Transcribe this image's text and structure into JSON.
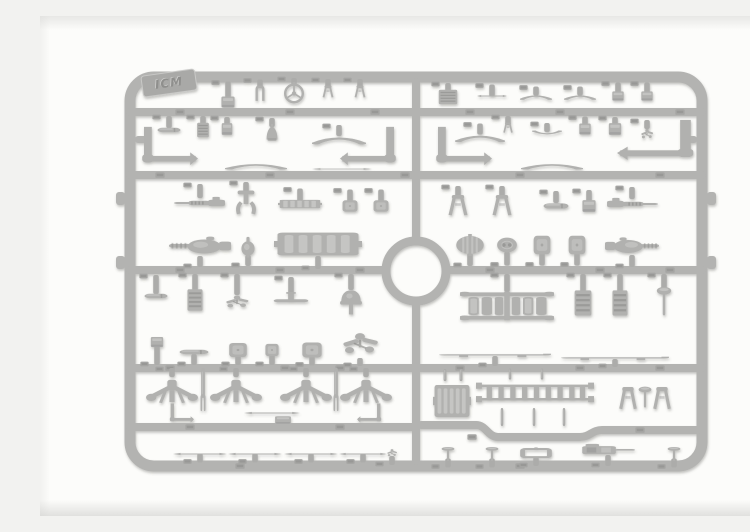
{
  "meta": {
    "alt": "Grey injection-moulded plastic model kit sprue with vehicle detail parts on a white background"
  },
  "logo": {
    "text": "ICM"
  },
  "palette": {
    "sprue": "#b3b3b1",
    "part": "#b1b1af",
    "light": "#d6d6d4",
    "dark": "#858583",
    "gate": "#acacaa",
    "tab": "#a5a5a3",
    "logoPlate": "#a9a9a7",
    "logoEdge": "#c9c9c7",
    "logoText": "#8f8f8d",
    "logoTextHi": "#cfcfcd"
  },
  "sprue": {
    "frame": {
      "x": 90,
      "y": 61,
      "w": 572,
      "h": 389,
      "r": 24,
      "bar": 11
    },
    "runners": [
      "M90 96 H662",
      "M90 159 H662",
      "M90 254 H346",
      "M406 254 H662",
      "M90 352 H662",
      "M90 411 H376",
      "M381 409 H436 C446 409 448 421 458 421 H540 C550 421 552 414 562 414 H658",
      "M376 66 V225",
      "M376 286 V445"
    ],
    "ring": {
      "cx": 376,
      "cy": 255,
      "r": 30,
      "bar": 9
    },
    "nubs": [
      [
        76,
        176,
        9,
        13
      ],
      [
        76,
        240,
        9,
        13
      ],
      [
        667,
        176,
        9,
        13
      ],
      [
        667,
        240,
        9,
        13
      ]
    ],
    "stubs": [
      [
        95,
        120,
        14,
        7
      ],
      [
        643,
        120,
        14,
        7
      ]
    ],
    "logoPos": {
      "x": 129,
      "y": 67,
      "w": 54,
      "h": 21,
      "rot": -8
    },
    "tabs": [
      [
        140,
        96
      ],
      [
        250,
        96
      ],
      [
        335,
        96
      ],
      [
        430,
        96
      ],
      [
        520,
        96
      ],
      [
        640,
        96
      ],
      [
        120,
        159
      ],
      [
        230,
        159
      ],
      [
        365,
        159
      ],
      [
        480,
        159
      ],
      [
        620,
        159
      ],
      [
        140,
        254
      ],
      [
        240,
        254
      ],
      [
        320,
        254
      ],
      [
        450,
        254
      ],
      [
        560,
        254
      ],
      [
        630,
        254
      ],
      [
        130,
        352
      ],
      [
        245,
        352
      ],
      [
        300,
        352
      ],
      [
        420,
        352
      ],
      [
        540,
        352
      ],
      [
        620,
        352
      ],
      [
        150,
        411
      ],
      [
        300,
        411
      ],
      [
        432,
        421
      ],
      [
        600,
        414
      ],
      [
        200,
        450
      ],
      [
        480,
        450
      ]
    ]
  },
  "parts": [
    {
      "n": "small-bracket",
      "t": "box",
      "x": 188,
      "y": 86,
      "w": 15,
      "h": 13,
      "gu": 14
    },
    {
      "n": "u-clamp",
      "t": "uclip",
      "x": 220,
      "y": 77,
      "w": 15,
      "h": 17,
      "gu": 5
    },
    {
      "n": "steering-wheel",
      "t": "wheel",
      "x": 254,
      "y": 77,
      "w": 22,
      "h": 22,
      "gu": 4
    },
    {
      "n": "lever-fork",
      "t": "fork",
      "x": 288,
      "y": 76,
      "w": 16,
      "h": 14,
      "gu": 6
    },
    {
      "n": "lever-fork",
      "t": "fork",
      "x": 320,
      "y": 76,
      "w": 16,
      "h": 14,
      "gu": 6
    },
    {
      "n": "vent-grille",
      "t": "grille",
      "x": 408,
      "y": 81,
      "w": 22,
      "h": 16,
      "gu": 6
    },
    {
      "n": "flat-bar",
      "t": "rodh",
      "x": 452,
      "y": 80,
      "w": 30,
      "h": 5,
      "gu": 9
    },
    {
      "n": "curved-brace",
      "t": "bow",
      "x": 496,
      "y": 81,
      "w": 32,
      "h": 9,
      "gu": 6
    },
    {
      "n": "curved-brace",
      "t": "bow",
      "x": 540,
      "y": 81,
      "w": 32,
      "h": 9,
      "gu": 6
    },
    {
      "n": "small-block",
      "t": "box",
      "x": 578,
      "y": 80,
      "w": 13,
      "h": 11,
      "gu": 8
    },
    {
      "n": "small-block",
      "t": "box",
      "x": 607,
      "y": 80,
      "w": 13,
      "h": 11,
      "gu": 8
    },
    {
      "n": "cylinder-device",
      "t": "pill",
      "x": 129,
      "y": 114,
      "w": 24,
      "h": 10,
      "gu": 9
    },
    {
      "n": "louver-panel",
      "t": "grille",
      "x": 163,
      "y": 114,
      "w": 14,
      "h": 16,
      "gu": 6
    },
    {
      "n": "junction-box",
      "t": "box",
      "x": 187,
      "y": 113,
      "w": 12,
      "h": 14,
      "gu": 5
    },
    {
      "n": "headlamp-bell",
      "t": "bell",
      "x": 232,
      "y": 117,
      "w": 17,
      "h": 18,
      "gu": 6
    },
    {
      "n": "spring-bow",
      "t": "bow",
      "x": 299,
      "y": 124,
      "w": 54,
      "h": 14,
      "gu": 8
    },
    {
      "n": "spring-bow",
      "t": "bow",
      "x": 440,
      "y": 122,
      "w": 50,
      "h": 13,
      "gu": 8
    },
    {
      "n": "twin-fork",
      "t": "fork",
      "x": 468,
      "y": 112,
      "w": 14,
      "h": 12,
      "gu": 6
    },
    {
      "n": "wing-brace",
      "t": "bow",
      "x": 507,
      "y": 117,
      "w": 30,
      "h": 8,
      "r": 180,
      "gu": 6
    },
    {
      "n": "small-block",
      "t": "box",
      "x": 545,
      "y": 113,
      "w": 13,
      "h": 13,
      "gu": 6
    },
    {
      "n": "small-block",
      "t": "box",
      "x": 575,
      "y": 113,
      "w": 14,
      "h": 14,
      "gu": 5
    },
    {
      "n": "linkage-cluster",
      "t": "spider",
      "x": 607,
      "y": 118,
      "w": 17,
      "h": 16,
      "gu": 6
    },
    {
      "n": "bent-pipe",
      "t": "lrod",
      "x": 128,
      "y": 132,
      "w": 60,
      "h": 44
    },
    {
      "n": "bent-pipe",
      "t": "lrod",
      "x": 330,
      "y": 132,
      "w": -60,
      "h": 44
    },
    {
      "n": "bent-pipe",
      "t": "lrod",
      "x": 422,
      "y": 132,
      "w": 60,
      "h": 44
    },
    {
      "n": "bent-pipe",
      "t": "lrod",
      "x": 618,
      "y": 126,
      "w": -82,
      "h": 46
    },
    {
      "n": "leaf-spring",
      "t": "bow",
      "x": 216,
      "y": 150,
      "w": 62,
      "h": 11
    },
    {
      "n": "tie-rod",
      "t": "rodh",
      "x": 302,
      "y": 153,
      "w": 60,
      "h": 4
    },
    {
      "n": "leaf-spring",
      "t": "bow",
      "x": 512,
      "y": 150,
      "w": 62,
      "h": 11
    },
    {
      "n": "machine-gun",
      "t": "mg",
      "x": 160,
      "y": 187,
      "w": 52,
      "h": 16,
      "gu": 11
    },
    {
      "n": "gun-pedestal",
      "t": "pedestal",
      "x": 206,
      "y": 187,
      "w": 30,
      "h": 26,
      "gu": 8
    },
    {
      "n": "track-links",
      "t": "slatbox",
      "x": 260,
      "y": 188,
      "w": 44,
      "h": 11,
      "gu": 10
    },
    {
      "n": "stowage-box",
      "t": "plate",
      "x": 310,
      "y": 190,
      "w": 17,
      "h": 13,
      "gu": 10
    },
    {
      "n": "stowage-box",
      "t": "plate",
      "x": 341,
      "y": 190,
      "w": 17,
      "h": 13,
      "gu": 10
    },
    {
      "n": "fender-arm",
      "t": "fork",
      "x": 418,
      "y": 190,
      "w": 28,
      "h": 24,
      "gu": 8
    },
    {
      "n": "fender-arm",
      "t": "fork",
      "x": 462,
      "y": 190,
      "w": -28,
      "h": 24,
      "gu": 8
    },
    {
      "n": "tank-cylinder",
      "t": "pill",
      "x": 516,
      "y": 190,
      "w": 26,
      "h": 12,
      "gu": 9
    },
    {
      "n": "valve-block",
      "t": "box",
      "x": 549,
      "y": 190,
      "w": 15,
      "h": 14,
      "gu": 9
    },
    {
      "n": "machine-gun",
      "t": "mg",
      "x": 592,
      "y": 188,
      "w": -52,
      "h": 16,
      "gu": 9
    },
    {
      "n": "gun-turret",
      "t": "turret",
      "x": 160,
      "y": 230,
      "w": 62,
      "h": 26,
      "gd": 8
    },
    {
      "n": "hatch-disc",
      "t": "disc",
      "x": 208,
      "y": 231,
      "w": 20,
      "h": 22,
      "gd": 8
    },
    {
      "n": "engine-block",
      "t": "slatbox",
      "x": 278,
      "y": 228,
      "w": 88,
      "h": 30,
      "gd": 10
    },
    {
      "n": "ribbed-barrel",
      "t": "barrel",
      "x": 430,
      "y": 229,
      "w": 30,
      "h": 22,
      "gd": 10
    },
    {
      "n": "gearbox",
      "t": "gear",
      "x": 467,
      "y": 229,
      "w": 22,
      "h": 19,
      "gd": 11
    },
    {
      "n": "armor-plate",
      "t": "plate",
      "x": 502,
      "y": 229,
      "w": 19,
      "h": 21,
      "gd": 10
    },
    {
      "n": "armor-plate",
      "t": "plate",
      "x": 537,
      "y": 229,
      "w": 19,
      "h": 21,
      "gd": 10
    },
    {
      "n": "gun-turret",
      "t": "turret",
      "x": 592,
      "y": 230,
      "w": -54,
      "h": 24,
      "gd": 9
    },
    {
      "n": "pump-body",
      "t": "pill",
      "x": 116,
      "y": 280,
      "w": 24,
      "h": 10,
      "gu": 16
    },
    {
      "n": "louver-panel",
      "t": "grille",
      "x": 155,
      "y": 284,
      "w": 18,
      "h": 24,
      "gu": 14
    },
    {
      "n": "linkage-cluster",
      "t": "spider",
      "x": 197,
      "y": 286,
      "w": 32,
      "h": 20,
      "gu": 18
    },
    {
      "n": "axle-tee",
      "t": "tflat",
      "x": 251,
      "y": 283,
      "w": 36,
      "h": 14,
      "gu": 15
    },
    {
      "n": "air-funnel",
      "t": "funnel",
      "x": 311,
      "y": 285,
      "w": 26,
      "h": 28,
      "gu": 13
    },
    {
      "n": "radiator-core",
      "t": "radiator",
      "x": 467,
      "y": 290,
      "w": 94,
      "h": 34,
      "gu": 15
    },
    {
      "n": "louver-panel",
      "t": "grille",
      "x": 543,
      "y": 287,
      "w": 20,
      "h": 28,
      "gu": 15
    },
    {
      "n": "louver-panel",
      "t": "grille",
      "x": 580,
      "y": 287,
      "w": 18,
      "h": 28,
      "gu": 15
    },
    {
      "n": "shift-lever",
      "t": "tvalve",
      "x": 624,
      "y": 285,
      "w": 18,
      "h": 30,
      "gu": 12
    },
    {
      "n": "small-block",
      "t": "box",
      "x": 117,
      "y": 326,
      "w": 14,
      "h": 12,
      "gd": 17
    },
    {
      "n": "muffler",
      "t": "pill",
      "x": 154,
      "y": 336,
      "w": 30,
      "h": 10,
      "gd": 8
    },
    {
      "n": "hatch-plate",
      "t": "plate",
      "x": 198,
      "y": 334,
      "w": 20,
      "h": 16,
      "gd": 7
    },
    {
      "n": "hatch-plate",
      "t": "plate",
      "x": 232,
      "y": 334,
      "w": 15,
      "h": 14,
      "gd": 8
    },
    {
      "n": "hatch-plate",
      "t": "plate",
      "x": 272,
      "y": 334,
      "w": 22,
      "h": 17,
      "gd": 7
    },
    {
      "n": "mg-mount-cluster",
      "t": "spider",
      "x": 320,
      "y": 328,
      "w": 50,
      "h": 34,
      "gd": 5
    },
    {
      "n": "running-board",
      "t": "runboard",
      "x": 455,
      "y": 339,
      "w": 112,
      "h": 8,
      "gd": 7
    },
    {
      "n": "running-board",
      "t": "runboard",
      "x": 575,
      "y": 342,
      "w": 108,
      "h": 8,
      "gd": 5
    },
    {
      "n": "suspension-arm",
      "t": "susp",
      "x": 132,
      "y": 376,
      "w": 52,
      "h": 36,
      "gu": 6
    },
    {
      "n": "suspension-arm",
      "t": "susp",
      "x": 196,
      "y": 376,
      "w": 52,
      "h": 36,
      "gu": 6
    },
    {
      "n": "suspension-arm",
      "t": "susp",
      "x": 266,
      "y": 376,
      "w": 52,
      "h": 36,
      "gu": 6
    },
    {
      "n": "suspension-arm",
      "t": "susp",
      "x": 326,
      "y": 376,
      "w": 52,
      "h": 36,
      "gu": 6
    },
    {
      "n": "fork-post",
      "t": "post",
      "x": 163,
      "y": 374,
      "w": 12,
      "h": 44
    },
    {
      "n": "fork-post",
      "t": "post",
      "x": 296,
      "y": 374,
      "w": 12,
      "h": 44
    },
    {
      "n": "step-bracket",
      "t": "lrod",
      "x": 141,
      "y": 398,
      "w": 26,
      "h": 22
    },
    {
      "n": "foot-board",
      "t": "rodh",
      "x": 232,
      "y": 397,
      "w": 56,
      "h": 5
    },
    {
      "n": "pedal-box",
      "t": "box",
      "x": 243,
      "y": 404,
      "w": 18,
      "h": 9
    },
    {
      "n": "step-bracket",
      "t": "lrod",
      "x": 330,
      "y": 398,
      "w": -26,
      "h": 22
    },
    {
      "n": "firewall-grille",
      "t": "slatbox",
      "x": 412,
      "y": 385,
      "w": 38,
      "h": 42
    },
    {
      "n": "gate",
      "t": "gate",
      "x": 405,
      "y": 359,
      "w": 8,
      "h": 12
    },
    {
      "n": "gate",
      "t": "gate",
      "x": 421,
      "y": 359,
      "w": 8,
      "h": 12
    },
    {
      "n": "access-ladder",
      "t": "ladder",
      "x": 495,
      "y": 377,
      "w": 118,
      "h": 28
    },
    {
      "n": "gate",
      "t": "gate",
      "x": 462,
      "y": 401,
      "w": 7,
      "h": 18
    },
    {
      "n": "gate",
      "t": "gate",
      "x": 494,
      "y": 401,
      "w": 7,
      "h": 18
    },
    {
      "n": "gate",
      "t": "gate",
      "x": 524,
      "y": 401,
      "w": 7,
      "h": 18
    },
    {
      "n": "gate",
      "t": "gate",
      "x": 470,
      "y": 358,
      "w": 7,
      "h": 11
    },
    {
      "n": "gate",
      "t": "gate",
      "x": 502,
      "y": 358,
      "w": 7,
      "h": 11
    },
    {
      "n": "clamp-fork",
      "t": "fork",
      "x": 588,
      "y": 383,
      "w": 26,
      "h": 26
    },
    {
      "n": "tee-handle",
      "t": "tvalve",
      "x": 605,
      "y": 381,
      "w": 16,
      "h": 22
    },
    {
      "n": "clamp-fork",
      "t": "fork",
      "x": 622,
      "y": 383,
      "w": -26,
      "h": 26
    },
    {
      "n": "axle-rod",
      "t": "rodh",
      "x": 160,
      "y": 438,
      "w": 54,
      "h": 5,
      "gd": 6
    },
    {
      "n": "axle-rod",
      "t": "rodh",
      "x": 215,
      "y": 438,
      "w": 54,
      "h": 5,
      "gd": 6
    },
    {
      "n": "axle-rod",
      "t": "rodh",
      "x": 271,
      "y": 438,
      "w": 54,
      "h": 5,
      "gd": 6
    },
    {
      "n": "axle-rod",
      "t": "rodh",
      "x": 323,
      "y": 438,
      "w": 48,
      "h": 5,
      "gd": 6
    },
    {
      "n": "grip-cluster",
      "t": "spider",
      "x": 352,
      "y": 437,
      "w": 14,
      "h": 12,
      "gd": 6
    },
    {
      "n": "tee-valve",
      "t": "tvalve",
      "x": 408,
      "y": 438,
      "w": 16,
      "h": 15,
      "gd": 6
    },
    {
      "n": "tee-valve",
      "t": "tvalve",
      "x": 452,
      "y": 438,
      "w": 16,
      "h": 15,
      "gd": 6
    },
    {
      "n": "frame-bracket",
      "t": "openframe",
      "x": 496,
      "y": 437,
      "w": 32,
      "h": 14,
      "gd": 6
    },
    {
      "n": "gun-breech",
      "t": "breech",
      "x": 568,
      "y": 434,
      "w": 56,
      "h": 16,
      "gd": 8
    },
    {
      "n": "tee-valve",
      "t": "tvalve",
      "x": 634,
      "y": 438,
      "w": 16,
      "h": 15,
      "gd": 6
    }
  ]
}
